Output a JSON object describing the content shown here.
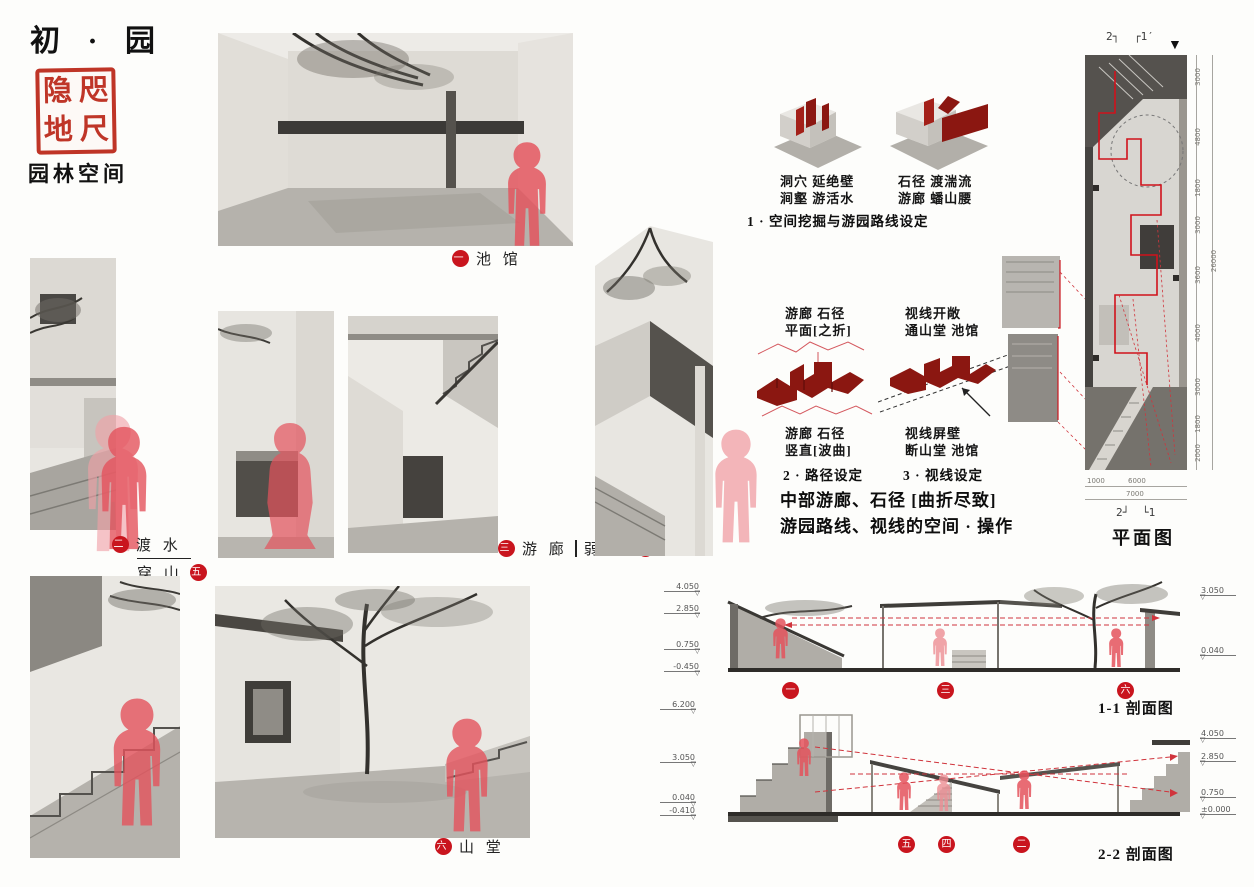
{
  "header": {
    "title": "初 · 园",
    "seal_chars": [
      "隐",
      "咫",
      "地",
      "尺"
    ],
    "subtitle": "园林空间"
  },
  "labels": {
    "pavilion": {
      "num": "一",
      "text": "池 馆"
    },
    "crossing": {
      "num": "二",
      "line1": "渡 水",
      "line2": "穿 山",
      "num2": "五"
    },
    "corridor": {
      "num": "三",
      "left": "游 廊",
      "right": "弱 径",
      "num2": "四"
    },
    "hall": {
      "num": "六",
      "text": "山 堂"
    }
  },
  "diagrams": {
    "step1": {
      "cap_a1": "洞穴 延绝壁",
      "cap_a2": "涧壑 游活水",
      "cap_b1": "石径 渡湍流",
      "cap_b2": "游廊 蟠山腰",
      "title": "1 · 空间挖掘与游园路线设定"
    },
    "step2": {
      "top1": "游廊 石径",
      "top2": "平面[之折]",
      "bot1": "游廊 石径",
      "bot2": "竖直[波曲]",
      "title": "2 · 路径设定"
    },
    "step3": {
      "top1": "视线开敞",
      "top2": "通山堂 池馆",
      "bot1": "视线屏壁",
      "bot2": "断山堂 池馆",
      "title": "3 · 视线设定"
    },
    "summary1": "中部游廊、石径 [曲折尽致]",
    "summary2": "游园路线、视线的空间 · 操作"
  },
  "plan": {
    "label": "平面图",
    "north_glyph": "▼",
    "marker_top_left": "2┐",
    "marker_top_right": "┌1′",
    "marker_bottom_left": "2┘",
    "marker_bottom_right": "└1",
    "dims_right": [
      "3000",
      "4800",
      "1800",
      "3000",
      "3600",
      "4000",
      "3000",
      "1800",
      "2000"
    ],
    "total_right": "26000",
    "dim_b1": "1000",
    "dim_b2": "6000",
    "total_bottom": "7000"
  },
  "sections": {
    "s1": {
      "label": "1-1 剖面图",
      "left_levels": [
        "4.050",
        "2.850",
        "0.750",
        "-0.450"
      ],
      "right_levels": [
        "3.050",
        "0.040"
      ],
      "markers": [
        "一",
        "三",
        "六"
      ]
    },
    "s2": {
      "label": "2-2 剖面图",
      "left_levels": [
        "6.200",
        "3.050",
        "0.040",
        "-0.410"
      ],
      "right_levels": [
        "4.050",
        "2.850",
        "0.750",
        "±0.000"
      ],
      "markers": [
        "五",
        "四",
        "二"
      ]
    }
  },
  "colors": {
    "accent": "#c9151e",
    "maroon": "#8b1711",
    "figure": "#e4525c",
    "pencil": "#8f8d88"
  }
}
